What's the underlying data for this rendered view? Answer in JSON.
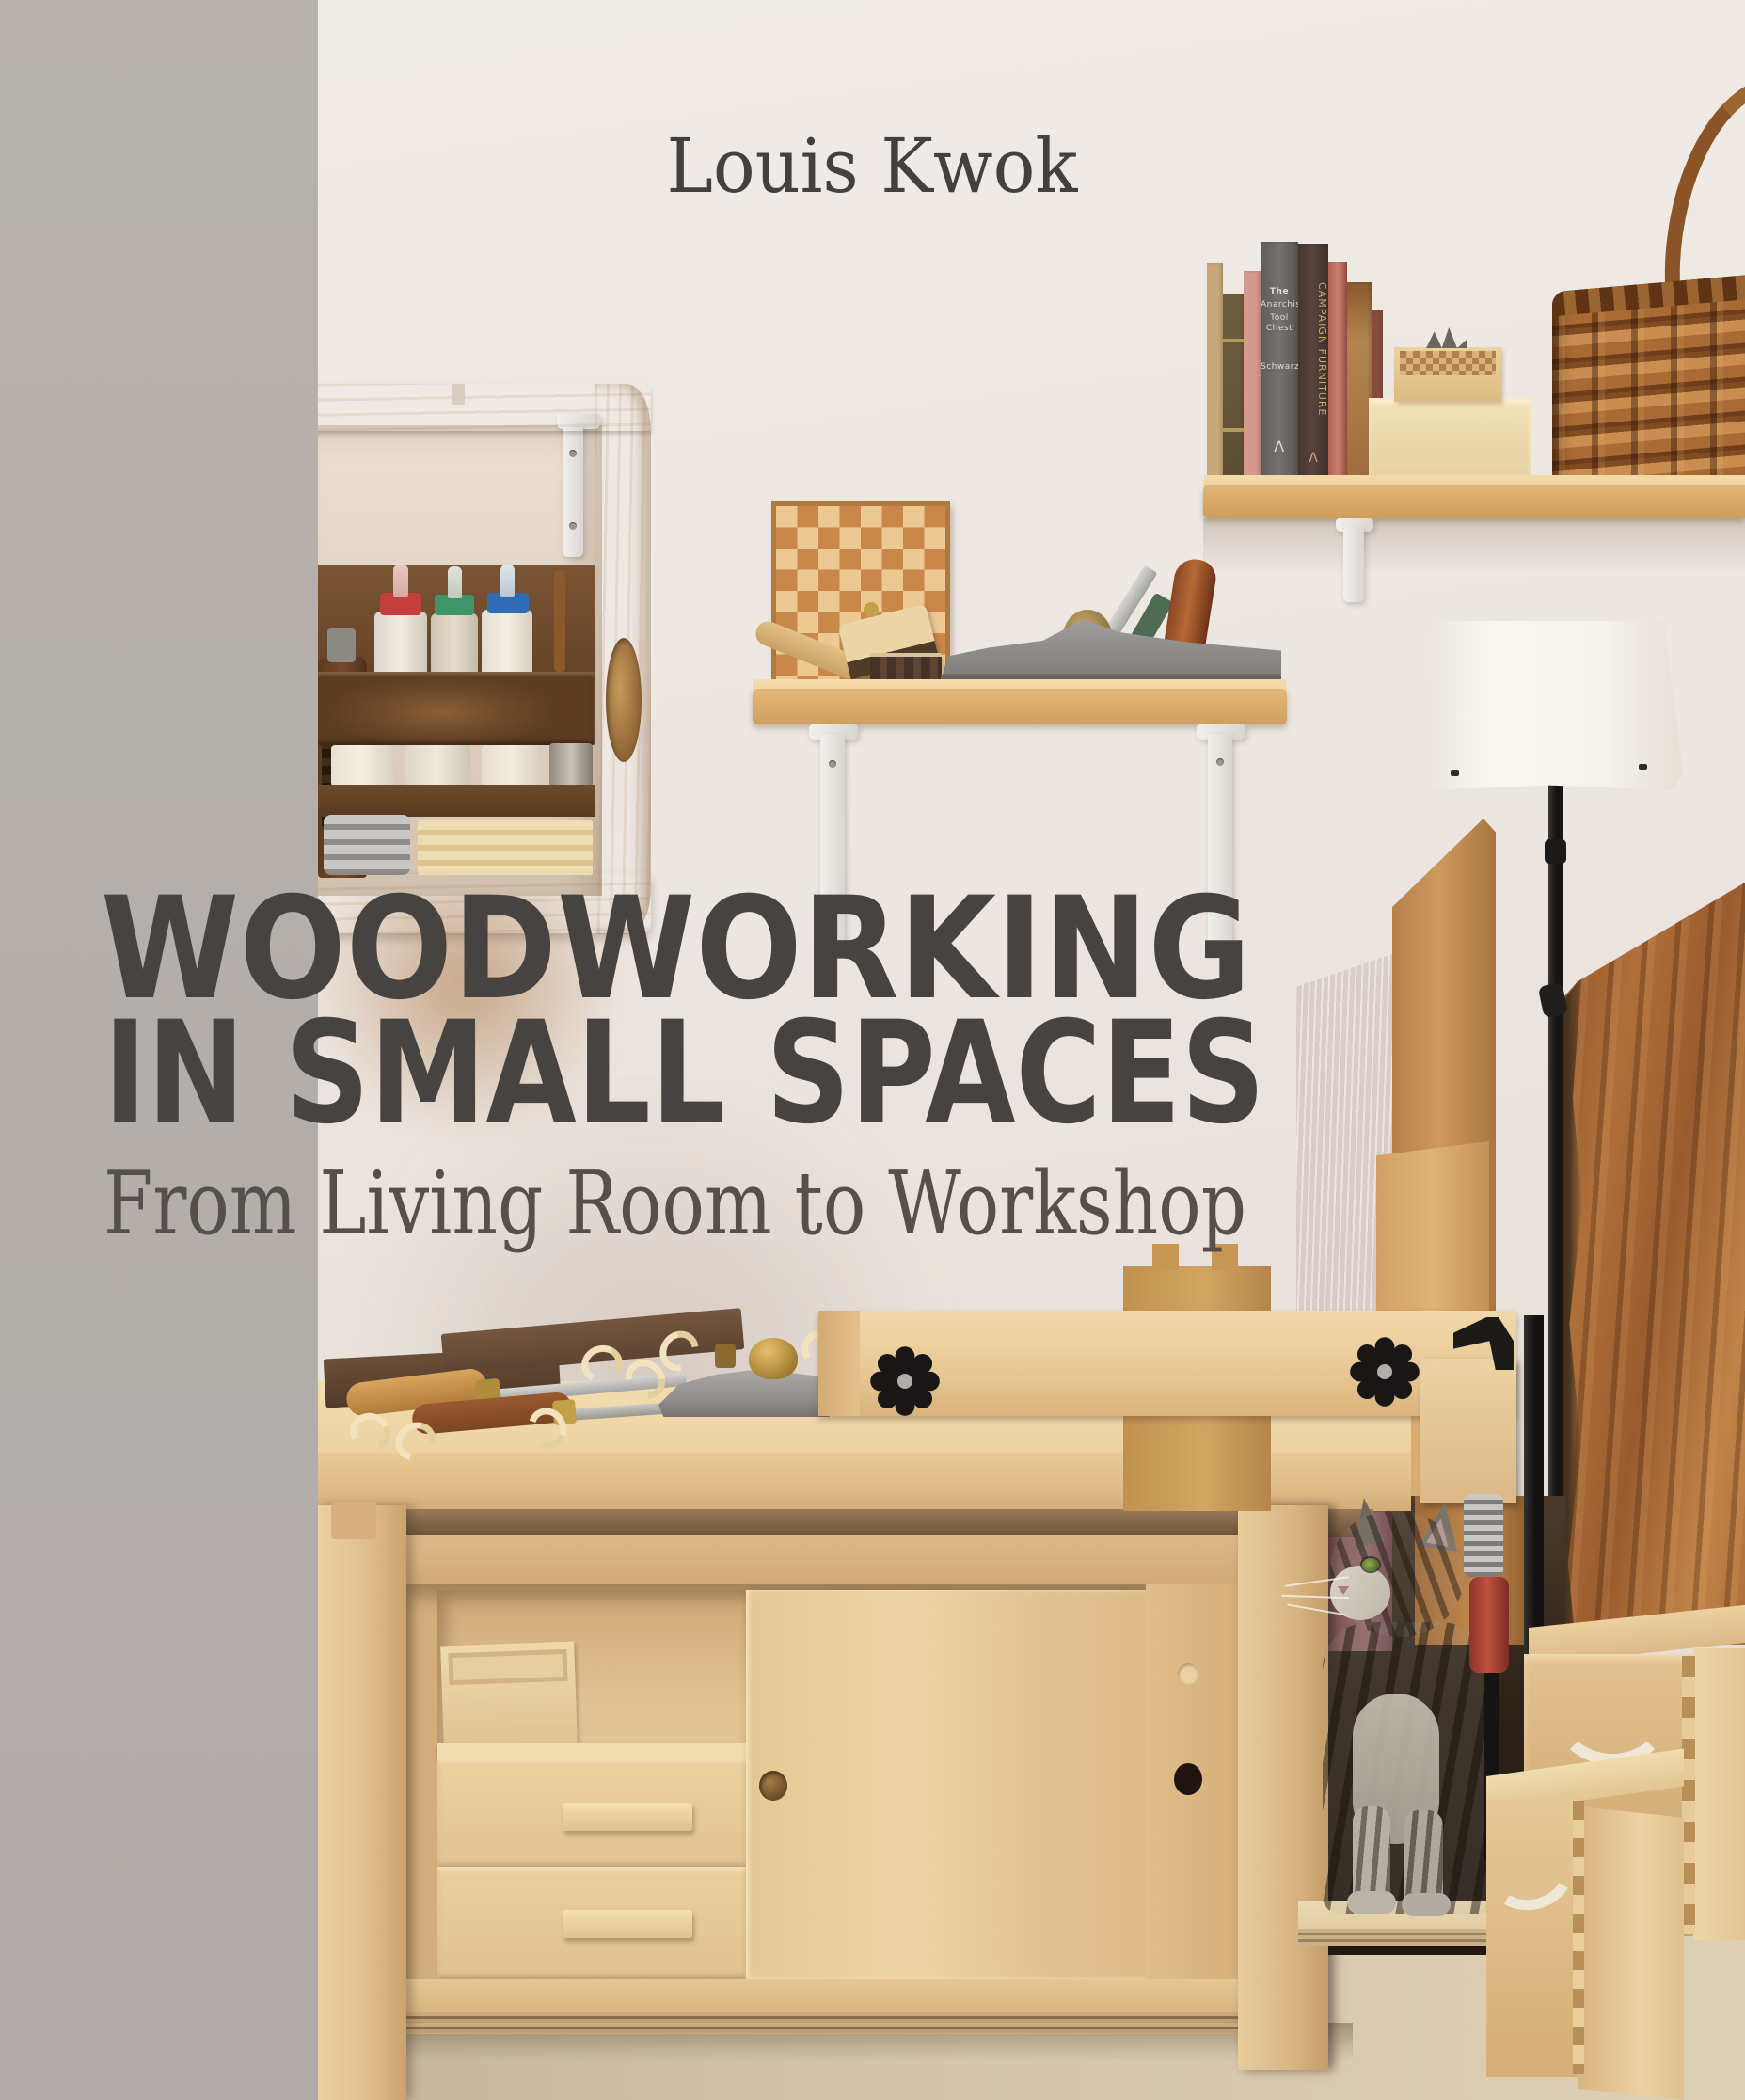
{
  "cover": {
    "author": "Louis Kwok",
    "title_line1": "WOODWORKING",
    "title_line2": "IN SMALL SPACES",
    "subtitle": "From Living Room to Workshop"
  },
  "colors": {
    "side_band": "#b4afab",
    "wall": "#ece6e1",
    "title_text": "#474341",
    "author_text": "#44403d",
    "subtitle_text": "#55504c",
    "pine_wood": "#e7c795",
    "dark_walnut": "#6b4a2e",
    "slab_wood": "#a35f2f",
    "glue_cap_red": "#c2403c",
    "glue_cap_green": "#3e9668",
    "glue_cap_blue": "#2f6cb5",
    "clamp_handle_red": "#b5473a"
  },
  "shelf_books": {
    "gray_spine_lines": [
      "The",
      "Anarchist's",
      "Tool Chest"
    ],
    "gray_spine_author": "Schwarz",
    "gray_spine_mark": "Λ",
    "brown_spine_title": "CAMPAIGN FURNITURE",
    "brown_spine_mark": "Λ"
  }
}
